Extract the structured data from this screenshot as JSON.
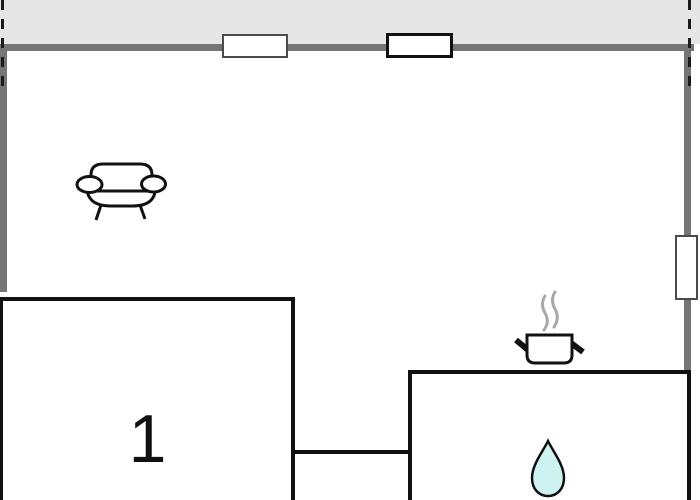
{
  "floorplan": {
    "room_label": "1",
    "icons": {
      "sofa": "sofa-icon",
      "cooking_pot": "cooking-pot-icon",
      "steam": "steam-lines-icon",
      "water_drop": "water-drop-icon"
    },
    "colors": {
      "outside_area": "#e6e6e6",
      "gray_wall": "#757575",
      "black_wall": "#111111",
      "interior": "#ffffff",
      "water_drop_fill": "#cdf2ef",
      "steam_gray": "#a8a8a8",
      "window_fill": "#ffffff"
    }
  }
}
